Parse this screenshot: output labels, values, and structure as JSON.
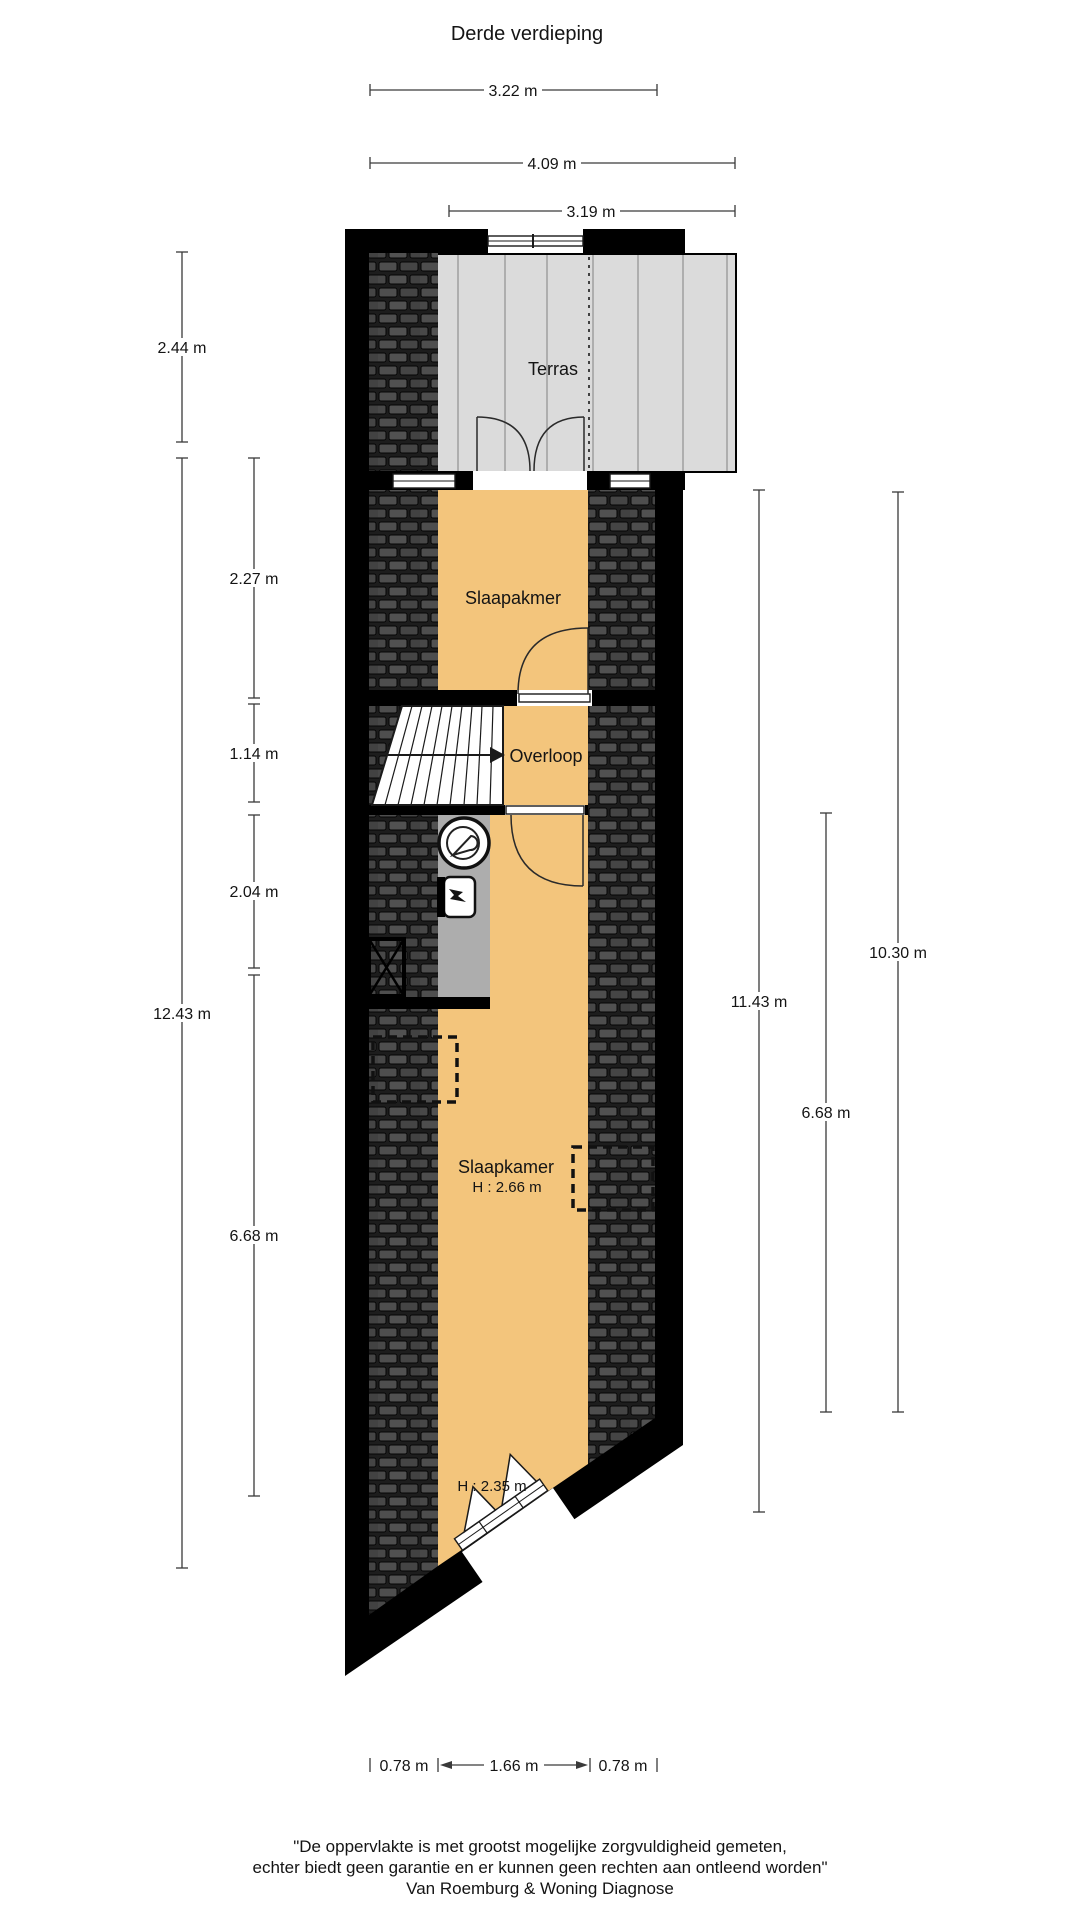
{
  "title": "Derde verdieping",
  "rooms": {
    "terras": {
      "label": "Terras"
    },
    "bedroom_top": {
      "label": "Slaapakmer"
    },
    "landing": {
      "label": "Overloop"
    },
    "bedroom_main": {
      "label": "Slaapkamer",
      "height": "H : 2.66 m"
    },
    "attic": {
      "height": "H : 2.35 m"
    }
  },
  "dimensions": {
    "top": {
      "w322": "3.22 m",
      "w409": "4.09 m",
      "w319": "3.19 m"
    },
    "left": {
      "h244": "2.44 m",
      "h227": "2.27 m",
      "h114": "1.14 m",
      "h204": "2.04 m",
      "h1243": "12.43 m",
      "h668": "6.68 m"
    },
    "right": {
      "h1143": "11.43 m",
      "h668": "6.68 m",
      "h1030": "10.30 m"
    },
    "bottom": {
      "w078a": "0.78 m",
      "w166": "1.66 m",
      "w078b": "0.78 m"
    }
  },
  "footer": {
    "line1": "\"De oppervlakte is met grootst mogelijke zorgvuldigheid gemeten,",
    "line2": "echter biedt geen garantie en er kunnen geen rechten aan ontleend worden\"",
    "line3": "Van Roemburg & Woning Diagnose"
  },
  "colors": {
    "floor_orange": "#F3C57C",
    "terrace_gray": "#DBDBDB",
    "bath_gray": "#ADADAD",
    "wall_black": "#000000"
  }
}
